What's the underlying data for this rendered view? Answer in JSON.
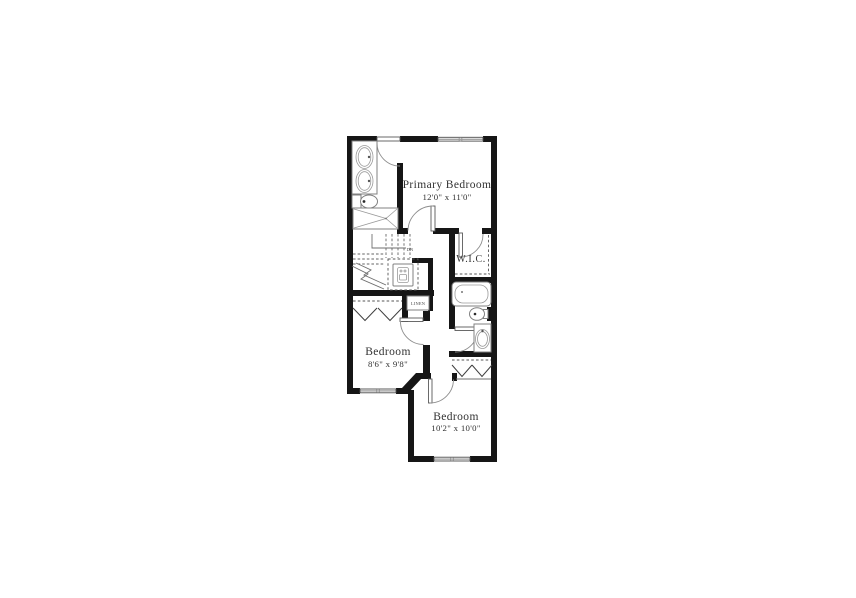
{
  "plan": {
    "title": "second-floor-plan",
    "rooms": {
      "primary_bedroom": {
        "name": "Primary Bedroom",
        "dimensions": "12'0\" x 11'0\""
      },
      "bedroom_2": {
        "name": "Bedroom",
        "dimensions": "8'6\" x 9'8\""
      },
      "bedroom_3": {
        "name": "Bedroom",
        "dimensions": "10'2\" x 10'0\""
      },
      "walk_in_closet": {
        "name": "W.I.C."
      },
      "linen_closet": {
        "name": "LINEN"
      },
      "stairs": {
        "direction_label": "DN"
      }
    },
    "colors": {
      "wall": "#161616",
      "fixture_line": "#808080",
      "text": "#323232",
      "background": "#ffffff"
    }
  }
}
